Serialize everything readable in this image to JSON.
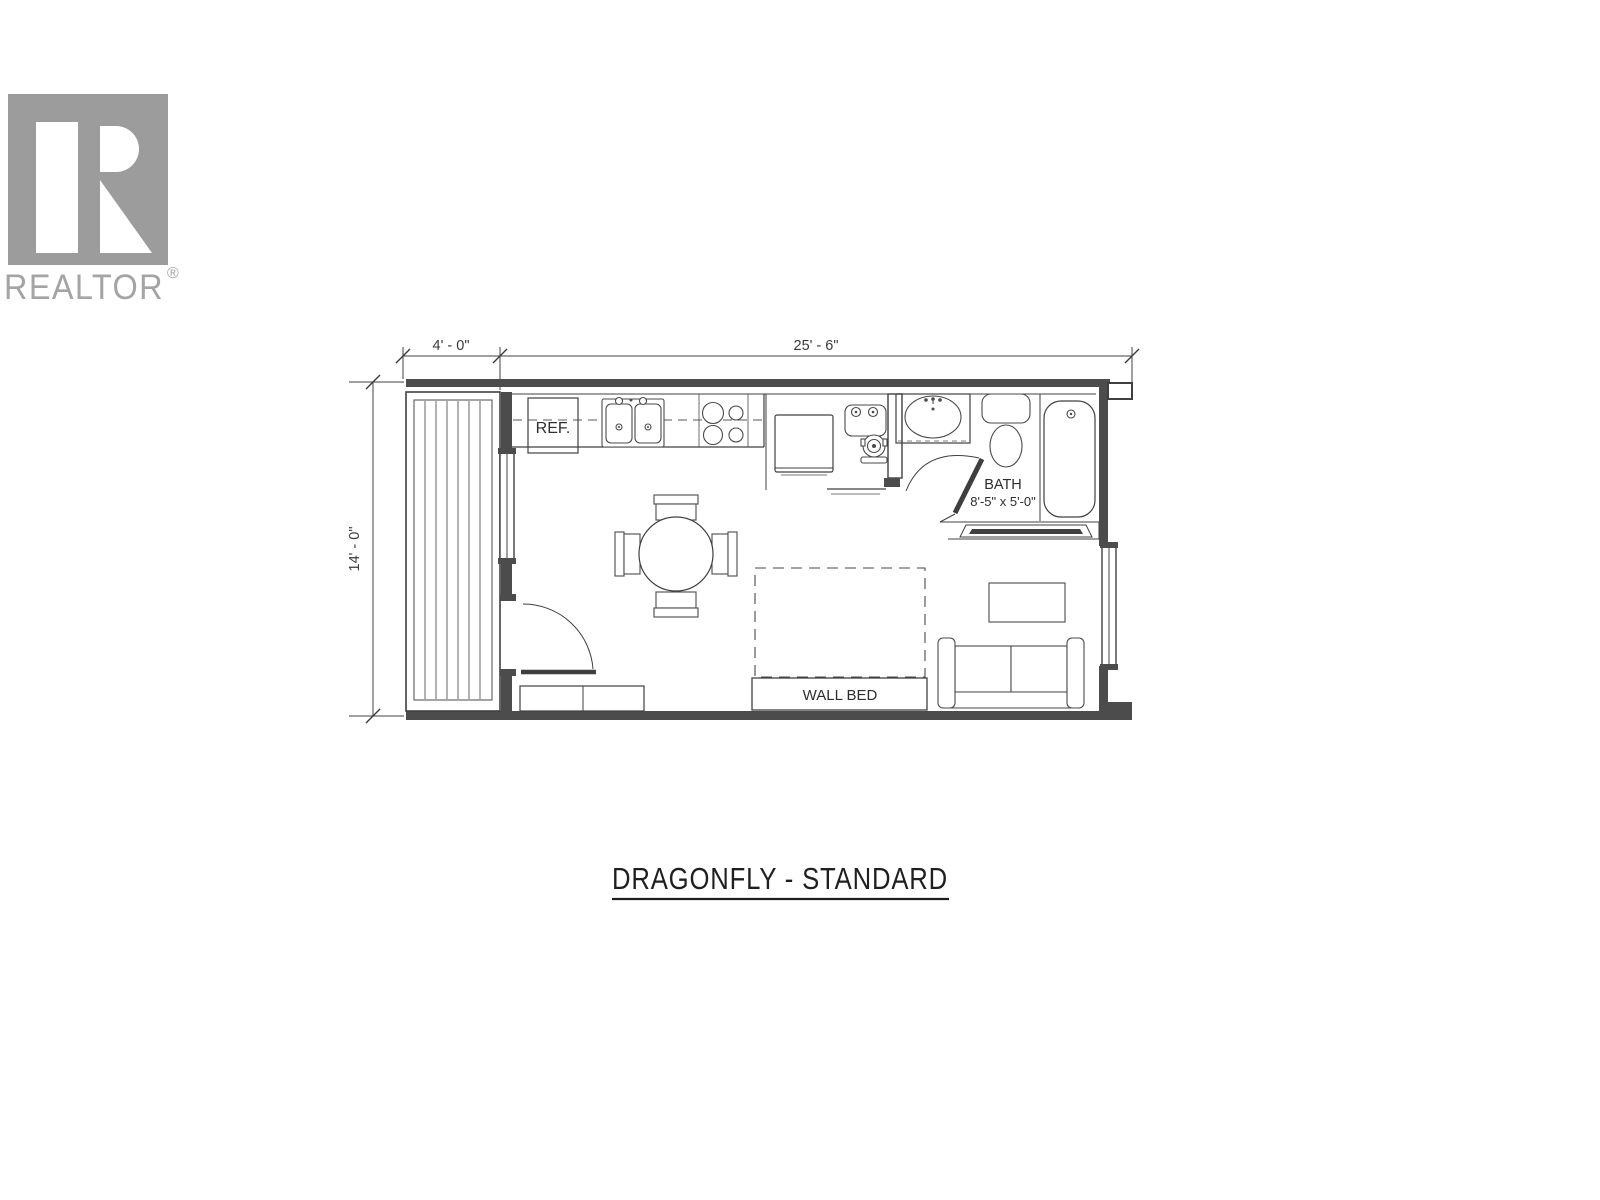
{
  "branding": {
    "logo_text": "REALTOR",
    "registered_mark": "®"
  },
  "floor_plan": {
    "title": "DRAGONFLY - STANDARD",
    "dimensions": {
      "porch_width": "4' - 0\"",
      "overall_width": "25' - 6\"",
      "overall_depth": "14' - 0\""
    },
    "labels": {
      "refrigerator": "REF.",
      "wall_bed": "WALL BED"
    },
    "bath": {
      "name": "BATH",
      "size": "8'-5\" x 5'-0\""
    }
  },
  "colors": {
    "background": "#ffffff",
    "line": "#404040",
    "wall_fill": "#4c4c4c",
    "logo_gray": "#9c9c9c",
    "logo_text_gray": "#a4a4a4",
    "title_text": "#1f1f1f"
  }
}
